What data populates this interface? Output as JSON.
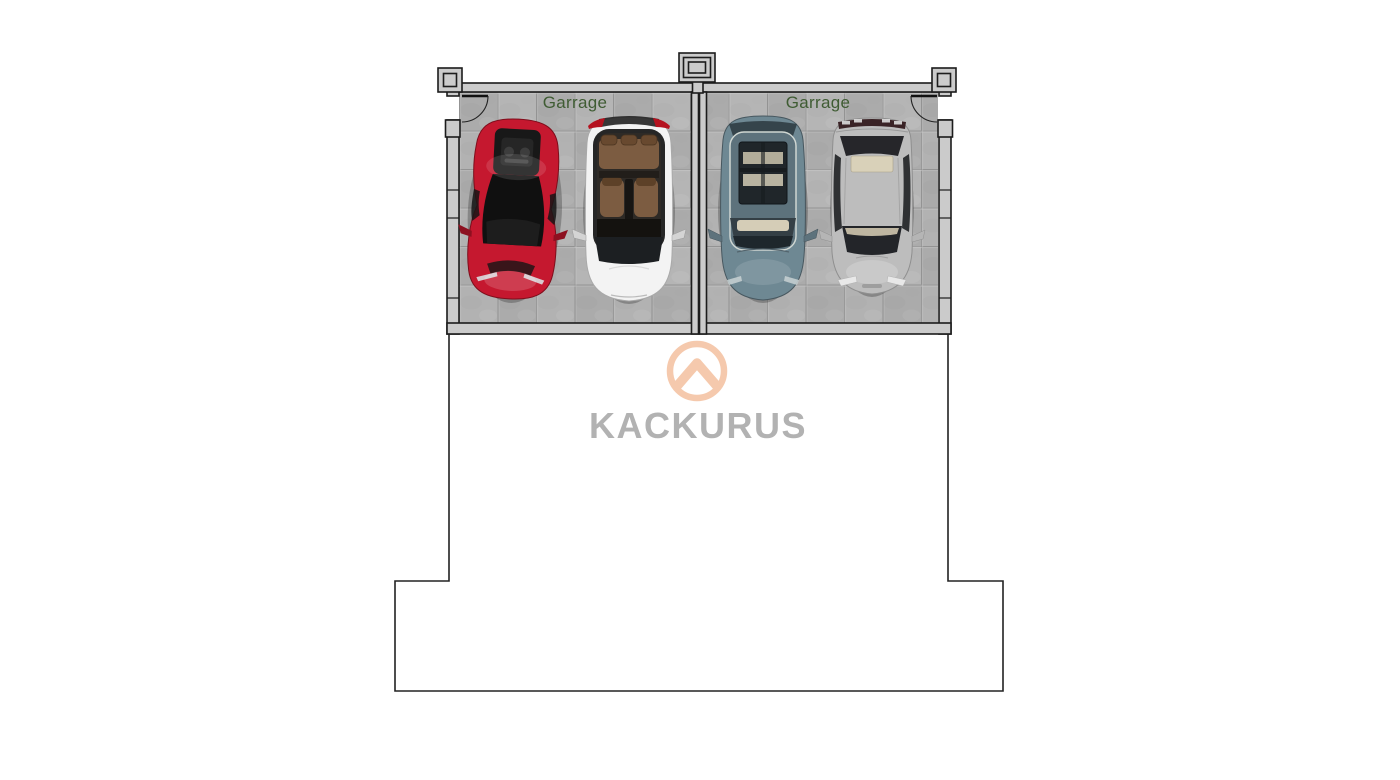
{
  "page": {
    "background_color": "#ffffff"
  },
  "floor_plan": {
    "outline_color": "#1c1c1c",
    "wall_fill_color": "#cbcbcb",
    "floor_tile_color": "#b2b2b2",
    "tile_grout_color": "#999999",
    "room_label_color": "#3f5c33",
    "garages": [
      {
        "label": "Garrage",
        "cars": [
          {
            "name": "red-sports-car",
            "body_color": "#c5182f"
          },
          {
            "name": "white-car-open-roof",
            "body_color": "#f3f3f3",
            "seat_color": "#7c5c41"
          }
        ]
      },
      {
        "label": "Garrage",
        "cars": [
          {
            "name": "teal-sedan",
            "body_color": "#6e8893"
          },
          {
            "name": "silver-sedan",
            "body_color": "#bdbdbd"
          }
        ]
      }
    ]
  },
  "watermark": {
    "brand_name": "KACKURUS",
    "logo_icon": "chevron-in-circle",
    "logo_color": "#f5c7a9",
    "brand_text_color": "#b2b2b2"
  }
}
